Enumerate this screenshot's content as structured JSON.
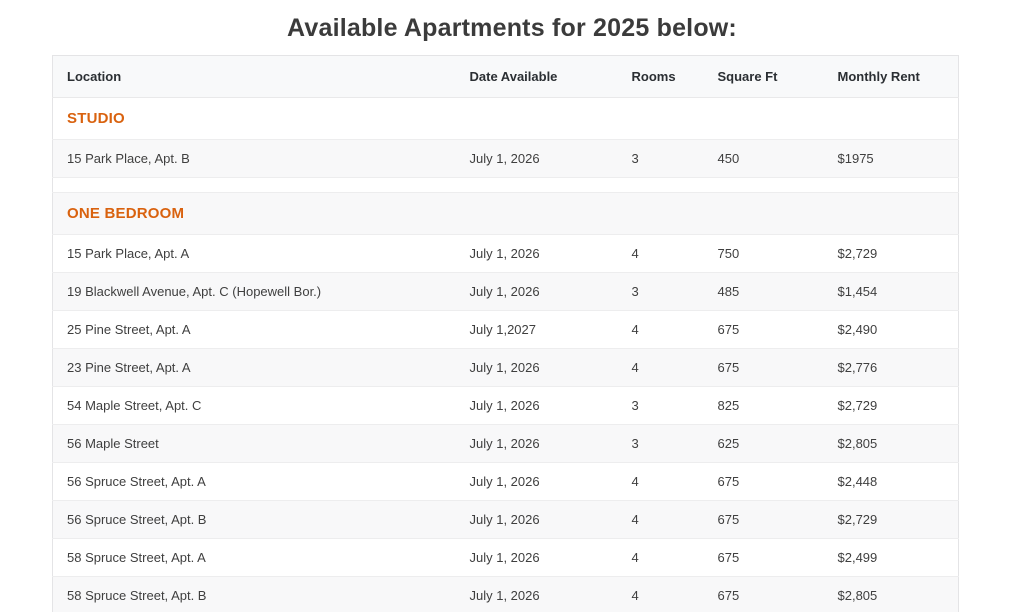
{
  "page": {
    "title": "Available Apartments for 2025 below:"
  },
  "theme": {
    "accent_orange": "#d9620f",
    "title_color": "#3b3b3b",
    "header_bg": "#f8f9fa",
    "stripe_bg": "#f8f8f9",
    "border_color": "#e9e9ea"
  },
  "table": {
    "columns": [
      "Location",
      "Date Available",
      "Rooms",
      "Square Ft",
      "Monthly Rent"
    ],
    "sections": [
      {
        "name": "STUDIO",
        "rows": [
          {
            "location": "15 Park Place, Apt. B",
            "date_available": "July 1, 2026",
            "rooms": "3",
            "square_ft": "450",
            "monthly_rent": "$1975"
          }
        ]
      },
      {
        "name": "ONE BEDROOM",
        "rows": [
          {
            "location": "15 Park Place, Apt. A",
            "date_available": "July 1, 2026",
            "rooms": "4",
            "square_ft": "750",
            "monthly_rent": "$2,729"
          },
          {
            "location": "19 Blackwell Avenue, Apt. C (Hopewell Bor.)",
            "date_available": "July 1, 2026",
            "rooms": "3",
            "square_ft": "485",
            "monthly_rent": "$1,454"
          },
          {
            "location": "25 Pine Street, Apt. A",
            "date_available": "July 1,2027",
            "rooms": "4",
            "square_ft": "675",
            "monthly_rent": "$2,490"
          },
          {
            "location": "23 Pine Street, Apt. A",
            "date_available": "July 1, 2026",
            "rooms": "4",
            "square_ft": "675",
            "monthly_rent": "$2,776"
          },
          {
            "location": "54 Maple Street, Apt. C",
            "date_available": "July 1, 2026",
            "rooms": "3",
            "square_ft": "825",
            "monthly_rent": "$2,729"
          },
          {
            "location": "56 Maple Street",
            "date_available": "July 1, 2026",
            "rooms": "3",
            "square_ft": "625",
            "monthly_rent": "$2,805"
          },
          {
            "location": "56 Spruce Street, Apt. A",
            "date_available": "July 1, 2026",
            "rooms": "4",
            "square_ft": "675",
            "monthly_rent": "$2,448"
          },
          {
            "location": "56 Spruce Street, Apt. B",
            "date_available": "July 1, 2026",
            "rooms": "4",
            "square_ft": "675",
            "monthly_rent": "$2,729"
          },
          {
            "location": "58 Spruce Street, Apt. A",
            "date_available": "July 1, 2026",
            "rooms": "4",
            "square_ft": "675",
            "monthly_rent": "$2,499"
          },
          {
            "location": "58 Spruce Street, Apt. B",
            "date_available": "July 1, 2026",
            "rooms": "4",
            "square_ft": "675",
            "monthly_rent": "$2,805"
          }
        ]
      }
    ]
  }
}
